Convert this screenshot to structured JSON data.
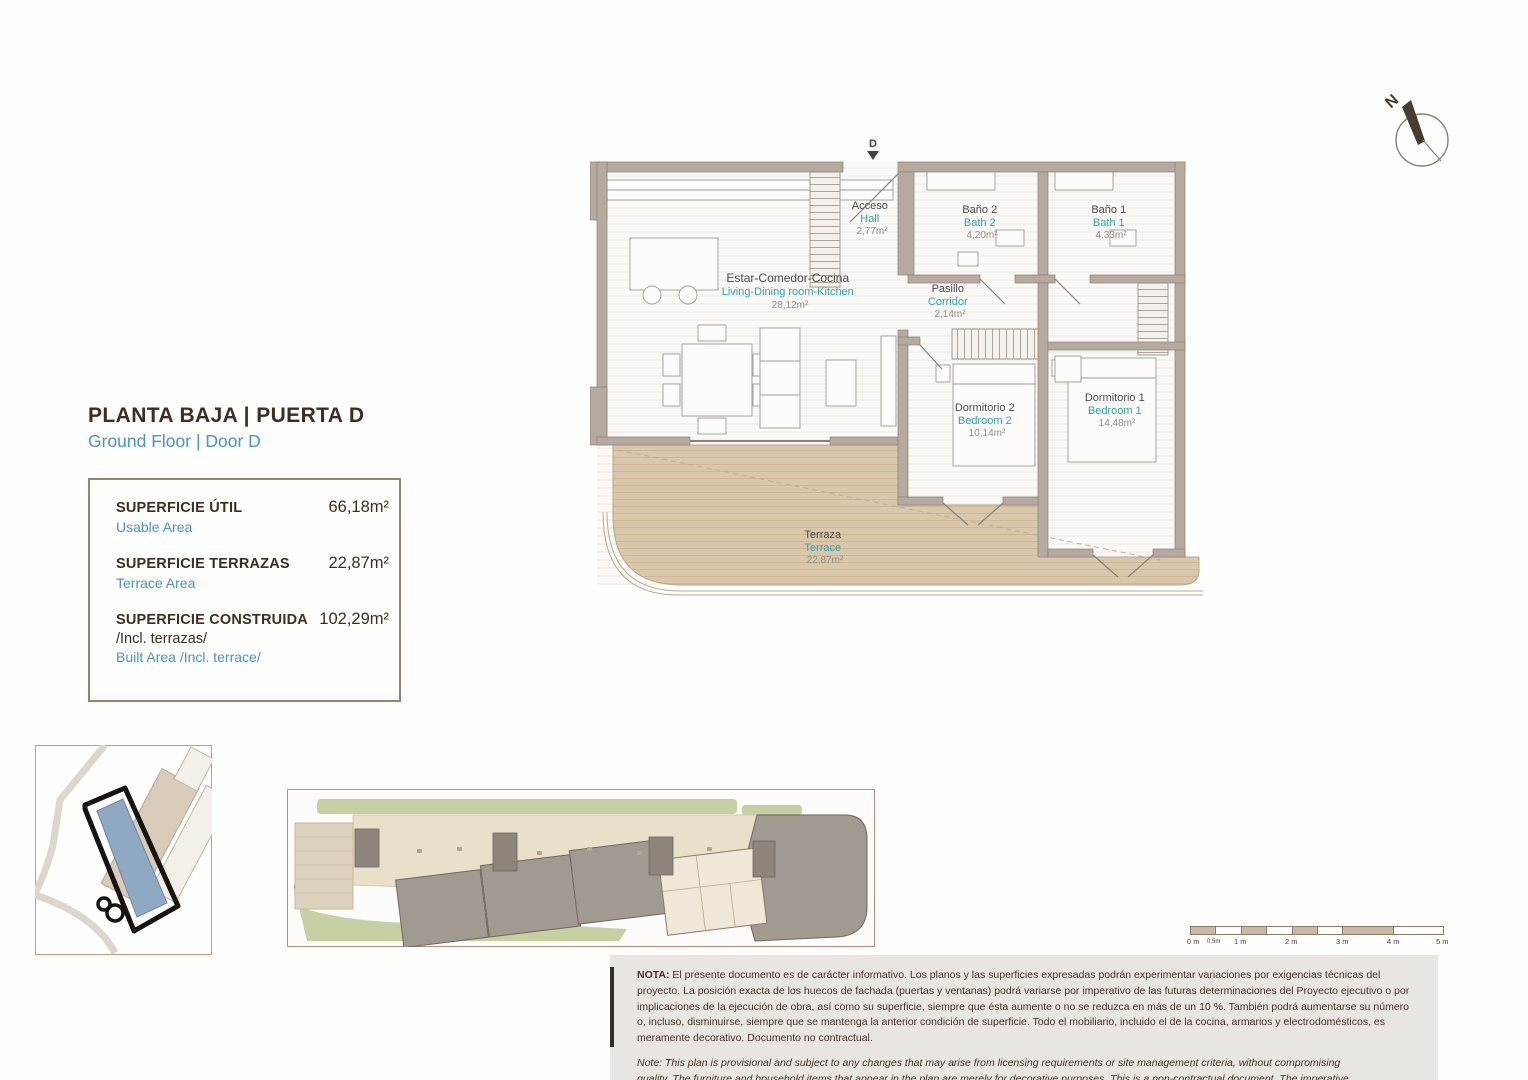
{
  "header": {
    "title": "PLANTA BAJA | PUERTA D",
    "subtitle": "Ground Floor | Door D"
  },
  "areas": {
    "usable_label": "SUPERFICIE ÚTIL",
    "usable_value": "66,18m²",
    "usable_sub": "Usable Area",
    "terrace_label": "SUPERFICIE TERRAZAS",
    "terrace_value": "22,87m²",
    "terrace_sub": "Terrace Area",
    "built_label": "SUPERFICIE CONSTRUIDA",
    "built_value": "102,29m²",
    "built_extra": "/Incl. terrazas/",
    "built_sub": "Built Area /Incl. terrace/"
  },
  "floorplan": {
    "entrance": "D",
    "rooms": {
      "hall": {
        "es": "Acceso",
        "en": "Hall",
        "area": "2,77m²"
      },
      "bath2": {
        "es": "Baño 2",
        "en": "Bath 2",
        "area": "4,20m²"
      },
      "bath1": {
        "es": "Baño 1",
        "en": "Bath 1",
        "area": "4,33m²"
      },
      "living": {
        "es": "Estar-Comedor-Cocina",
        "en": "Living-Dining room-Kitchen",
        "area": "28,12m²"
      },
      "corridor": {
        "es": "Pasillo",
        "en": "Corridor",
        "area": "2,14m²"
      },
      "bedroom2": {
        "es": "Dormitorio 2",
        "en": "Bedroom 2",
        "area": "10,14m²"
      },
      "bedroom1": {
        "es": "Dormitorio 1",
        "en": "Bedroom 1",
        "area": "14,48m²"
      },
      "terrace": {
        "es": "Terraza",
        "en": "Terrace",
        "area": "22,87m²"
      }
    }
  },
  "compass": {
    "label": "N"
  },
  "scalebar": {
    "labels": [
      "0 m",
      "0,5m",
      "1 m",
      "2 m",
      "3 m",
      "4 m",
      "5 m"
    ]
  },
  "notes": {
    "es_label": "NOTA:",
    "es": " El presente documento es de carácter informativo. Los planos y las superficies expresadas podrán experimentar variaciones por exigencias técnicas del proyecto. La posición exacta de los huecos de fachada (puertas y ventanas) podrá variarse por imperativo de las futuras determinaciones del Proyecto ejecutivo o por implicaciones de la ejecución de obra, así como su superficie, siempre que ésta aumente o no se reduzca en más de un 10 %. También podrá aumentarse su número o, incluso, disminuirse, siempre que se mantenga la anterior condición de superficie. Todo el mobiliario, incluido el de la cocina, armarios y electrodomésticos, es meramente decorativo. Documento no contractual.",
    "en": "Note: This plan is provisional and subject to any changes that may arise from licensing requirements or site management criteria, without compromising quality. The furniture and household items that appear in the plan are merely for decorative purposes. This is a non-contractual document. The imperative determinations of the Executive Project or by implications works of the execution, can change the exact position of the facade of doors and windows, as well the surface area may also be increased or even decrease not more than a 10%.",
    "version": "V.1_JUN-25"
  },
  "colors": {
    "accent_teal": "#2fa3ad",
    "subtitle_blue": "#4a96ba",
    "title_brown": "#3e2d25",
    "wall": "#b4aaa0",
    "terrace_fill": "#d9c6a9",
    "highlight_blue": "#8fa9c3",
    "note_bg": "#e9e5e0"
  }
}
